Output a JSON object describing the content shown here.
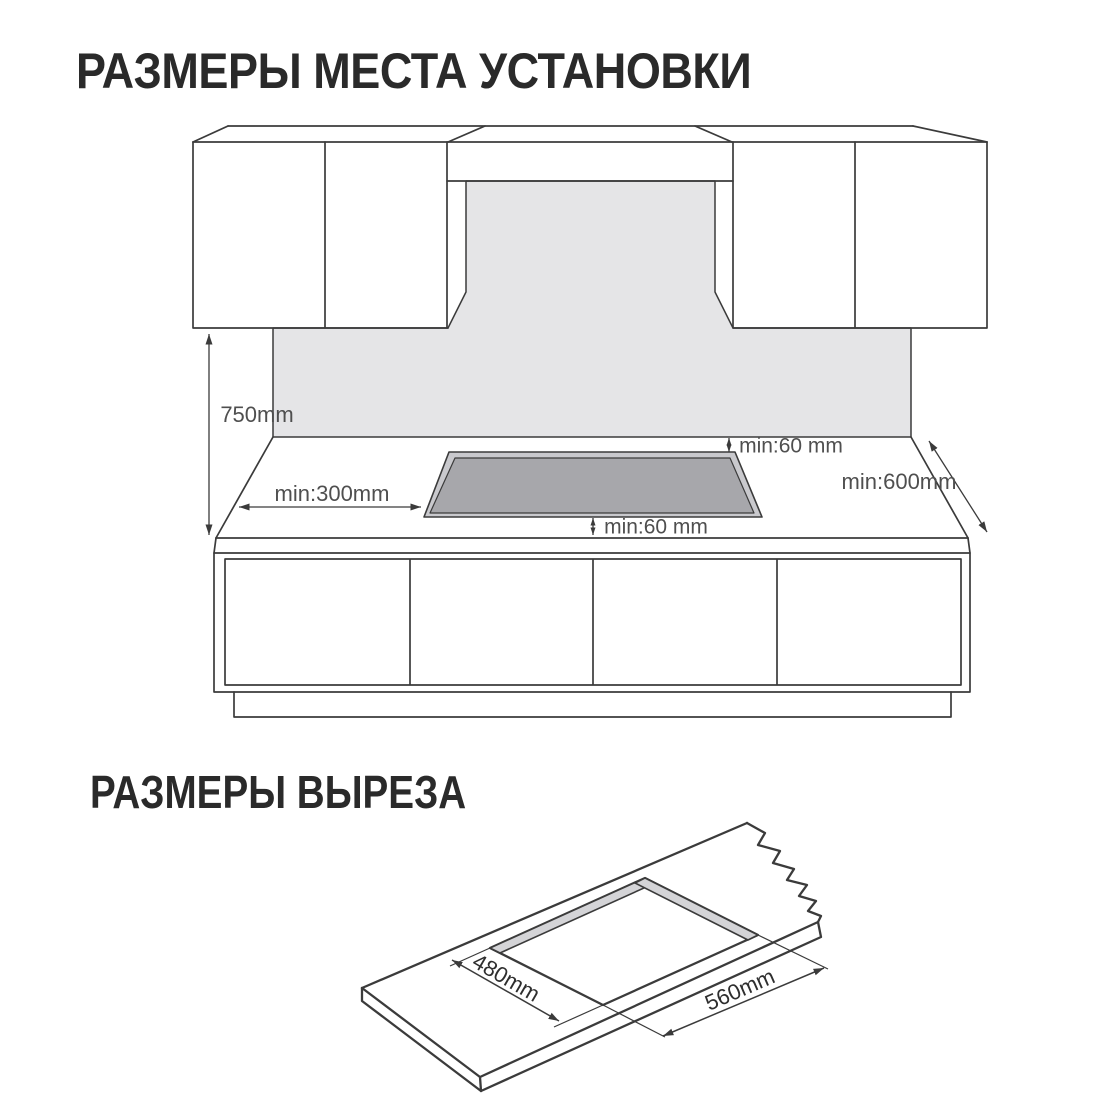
{
  "installation": {
    "title": "РАЗМЕРЫ МЕСТА УСТАНОВКИ",
    "labels": {
      "hood_height": "750mm",
      "side_clearance": "min:300mm",
      "rear_clearance": "min:60 mm",
      "front_clearance": "min:60 mm",
      "worktop_depth": "min:600mm"
    }
  },
  "cutout": {
    "title": "РАЗМЕРЫ ВЫРЕЗА",
    "labels": {
      "cutout_depth": "480mm",
      "cutout_width": "560mm"
    }
  },
  "colors": {
    "line": "#3b3b3b",
    "heading": "#2a2a2a",
    "dim_text": "#4f4f4f",
    "dim_text_dark": "#2e2e2e",
    "wall_gray": "#e5e5e7",
    "cooktop_gray": "#a7a7ab",
    "cooktop_rim": "#c9c9cd",
    "cutout_wall_gray": "#d4d4d7"
  }
}
